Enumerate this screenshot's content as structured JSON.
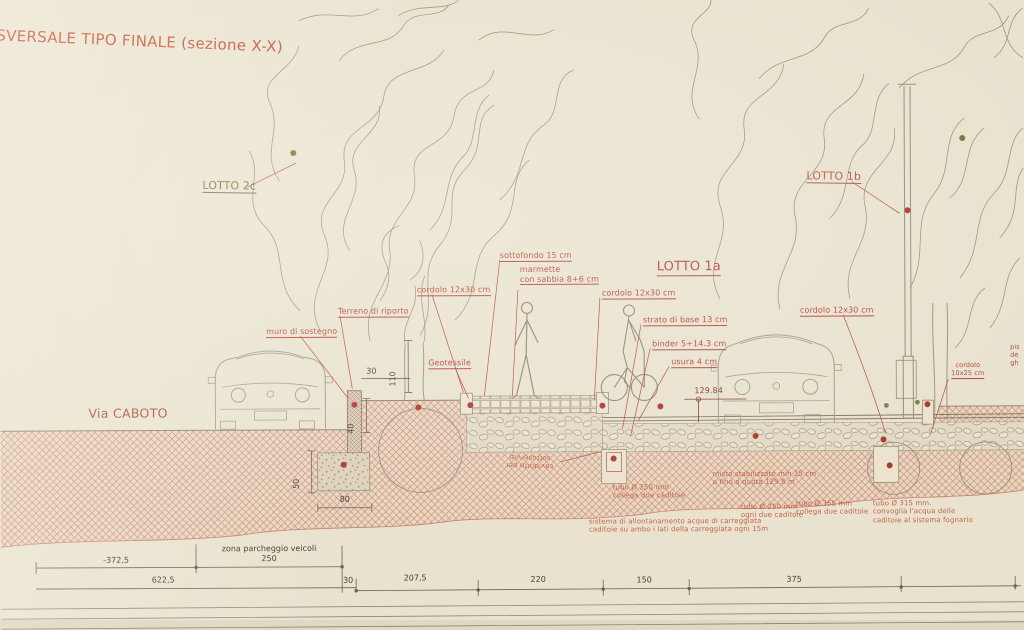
{
  "title": "SVERSALE TIPO FINALE (sezione X-X)",
  "street_label": "Via CABOTO",
  "lots": {
    "lotto_2c": "LOTTO 2c",
    "lotto_1b": "LOTTO 1b",
    "lotto_1a": "LOTTO 1a"
  },
  "annotations": {
    "sottofondo": "sottofondo 15 cm",
    "marmette": "marmette\ncon sabbia 8+6 cm",
    "cordolo_sx": "cordolo 12x30 cm",
    "terreno_riporto": "Terreno di riporto",
    "muro_sostegno": "muro di sostegno",
    "geotessile": "Geotessile",
    "cordolo_centro": "cordolo 12x30 cm",
    "strato_base": "strato di base 13 cm",
    "binder": "binder 5÷14.3 cm",
    "usura": "usura 4 cm",
    "quota": "129.84",
    "cordolo_dx": "cordolo 12x30 cm",
    "cordolo_10x25": "cordolo\n10x25 cm",
    "edge_note": "pis\nde\ngh",
    "cavidotto": "cavidotto per\nsottoservizi",
    "tubo_250_collega": "tubo Ø 250 mm\ncollega due caditoie",
    "misto": "misto stabilizzato min 25 cm\no fino a quota 129.8 m",
    "tubo_250_ogni": "tubo Ø 250 mm\nogni due caditoie",
    "tubo_355": "tubo Ø 355 mm\ncollega due caditoie",
    "tubo_315": "tubo Ø 315 mm.\nconvoglia l'acqua delle\ncaditoie al sistema fognario",
    "sistema": "sistema di allontanamento acque di carreggiata\ncaditoie su ambo i lati della carreggiata ogni 15m"
  },
  "dimensions": {
    "neg_372_5": "-372,5",
    "zona_parcheggio": "zona parcheggio veicoli\n250",
    "d622_5": "622,5",
    "d30": "30",
    "d207_5": "207,5",
    "d220": "220",
    "d150": "150",
    "d375": "375",
    "v110": "110",
    "v30": "30",
    "v40": "40",
    "v50": "50",
    "h80": "80"
  },
  "colors": {
    "ink_red": "#b5483a",
    "ink_olive": "#75703c",
    "paper": "#e9e2cf",
    "earth_hatch": "#c9816b",
    "line_gray": "#6b6254"
  }
}
